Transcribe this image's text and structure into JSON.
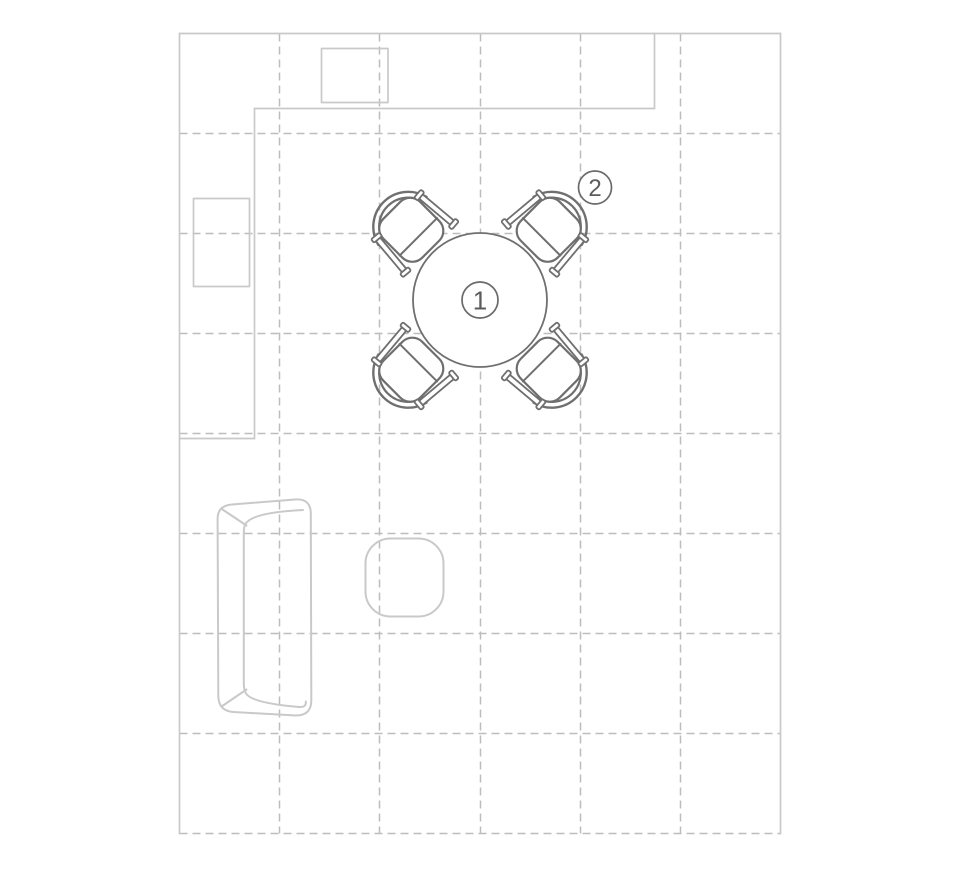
{
  "palette": {
    "background": "#ffffff",
    "wall_stroke": "#c9c9c9",
    "grid_stroke": "#bdbdbd",
    "light_furniture_stroke": "#c9c9c9",
    "dark_furniture_stroke": "#6f6f6f",
    "label_circle_stroke": "#6a6a6a",
    "label_text_color": "#5c5c5c"
  },
  "floor_plan": {
    "markers": {
      "table": "1",
      "chair": "2"
    }
  }
}
